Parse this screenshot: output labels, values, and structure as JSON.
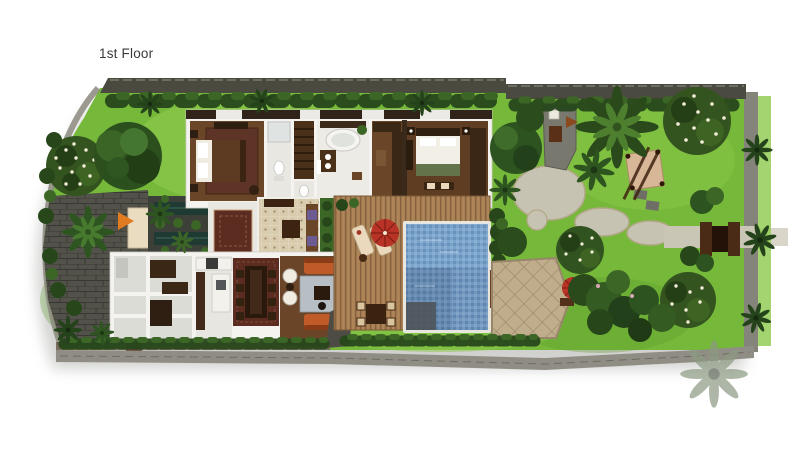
{
  "plan": {
    "title": "1st Floor"
  },
  "palette": {
    "bg": "#ffffff",
    "text": "#3a3a3a",
    "lawn": "#76b83a",
    "lawnLight": "#8cc94b",
    "lawnDark": "#5e9c2e",
    "treeDark": "#27471b",
    "treeMid": "#3c6626",
    "treeLight": "#588f33",
    "flower": "#f2ecd8",
    "wallDark": "#4b4a40",
    "wallMid": "#85847a",
    "wallLight": "#908e84",
    "building": "#f4f3f0",
    "floorGray": "#e8e7e2",
    "wood": "#6b4527",
    "woodDark": "#3a2715",
    "deck": "#aa7f52",
    "poolLight": "#7ba4cc",
    "poolDark": "#5b80a6",
    "paving": "#52524a",
    "path": "#c7c3b2",
    "terrace": "#bfad8c",
    "tile": "#d9cbae",
    "rugRed": "#5c2c20",
    "rugBlue": "#b7bfc5",
    "sofa": "#c05a28",
    "cream": "#ead9bd",
    "umbrella": "#b93226",
    "water": "#1f3a33",
    "arrow": "#e07b20",
    "purple": "#6c5a92"
  },
  "features": [
    "boundary-walls",
    "west-garden",
    "master-bedroom",
    "ensuite-bathroom",
    "stairs",
    "tub-bathroom",
    "wardrobe",
    "guest-bedroom",
    "entry-foyer",
    "water-garden-courtyard",
    "service-rooms",
    "kitchen",
    "dining-room",
    "living-room",
    "timber-pool-deck",
    "swimming-pool",
    "sun-loungers",
    "pool-parasol",
    "outdoor-dining-set",
    "stone-terrace",
    "garden-pavilion",
    "stone-paths",
    "entrance-gate",
    "east-garden"
  ]
}
